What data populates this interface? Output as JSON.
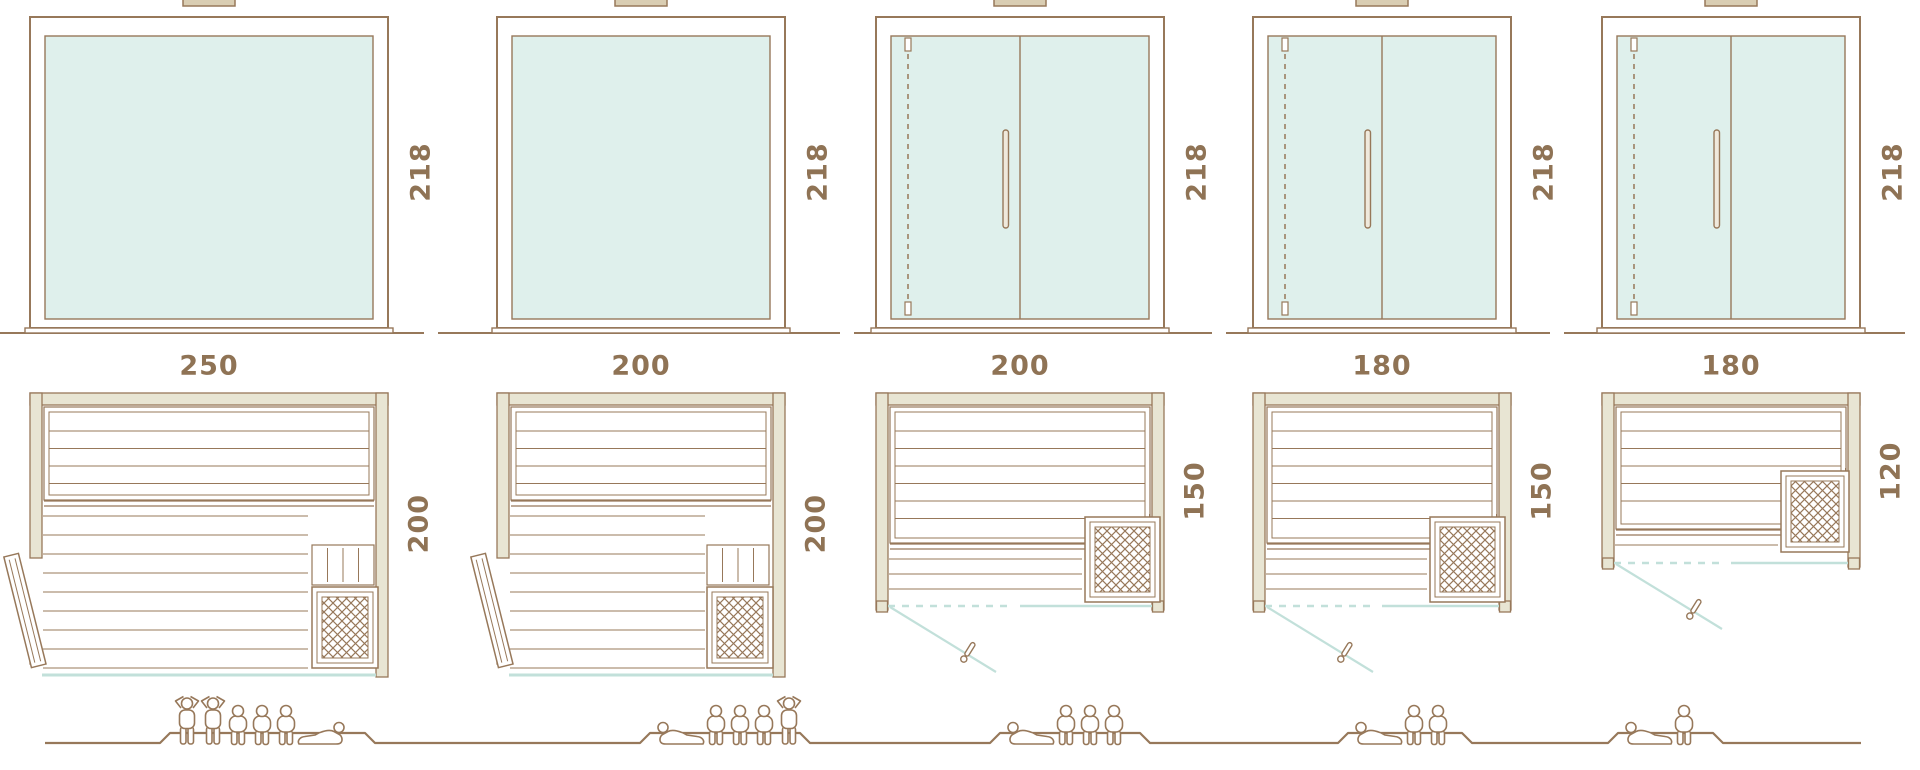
{
  "diagram": {
    "type": "sauna-model-size-comparison",
    "rows": [
      "front-elevation",
      "floor-plan",
      "capacity-figures"
    ],
    "units": "cm"
  },
  "palette": {
    "background": "#ffffff",
    "outline": "#97785a",
    "dimension_text": "#8f7355",
    "wall_fill": "#e8e5d3",
    "wood_fill": "#d9cdb2",
    "glass_fill": "#dff0ec",
    "door_swing": "#c2e0da"
  },
  "models": [
    {
      "name": "sauna-250x200",
      "elevation": {
        "width": "250",
        "height": "218",
        "front": "fixed glass panel"
      },
      "plan": {
        "depth": "200",
        "door": "hinged wood door left",
        "heater": "corner heater bottom right"
      },
      "capacity": {
        "count": 6,
        "figures": [
          "standing",
          "standing",
          "sitting",
          "sitting",
          "sitting",
          "lying"
        ]
      }
    },
    {
      "name": "sauna-200x200",
      "elevation": {
        "width": "200",
        "height": "218",
        "front": "fixed glass panel"
      },
      "plan": {
        "depth": "200",
        "door": "hinged wood door left",
        "heater": "corner heater bottom right"
      },
      "capacity": {
        "count": 5,
        "figures": [
          "lying",
          "sitting",
          "sitting",
          "sitting",
          "standing"
        ]
      }
    },
    {
      "name": "sauna-200x150",
      "elevation": {
        "width": "200",
        "height": "218",
        "front": "glass door with fixed panel"
      },
      "plan": {
        "depth": "150",
        "door": "hinged glass door left",
        "heater": "corner heater bottom right"
      },
      "capacity": {
        "count": 4,
        "figures": [
          "lying",
          "sitting",
          "sitting",
          "sitting"
        ]
      }
    },
    {
      "name": "sauna-180x150",
      "elevation": {
        "width": "180",
        "height": "218",
        "front": "glass door with fixed panel"
      },
      "plan": {
        "depth": "150",
        "door": "hinged glass door left",
        "heater": "corner heater bottom right"
      },
      "capacity": {
        "count": 3,
        "figures": [
          "lying",
          "sitting",
          "sitting"
        ]
      }
    },
    {
      "name": "sauna-180x120",
      "elevation": {
        "width": "180",
        "height": "218",
        "front": "glass door with fixed panel"
      },
      "plan": {
        "depth": "120",
        "door": "hinged glass door left",
        "heater": "corner heater bottom right"
      },
      "capacity": {
        "count": 2,
        "figures": [
          "lying",
          "sitting"
        ]
      }
    }
  ]
}
